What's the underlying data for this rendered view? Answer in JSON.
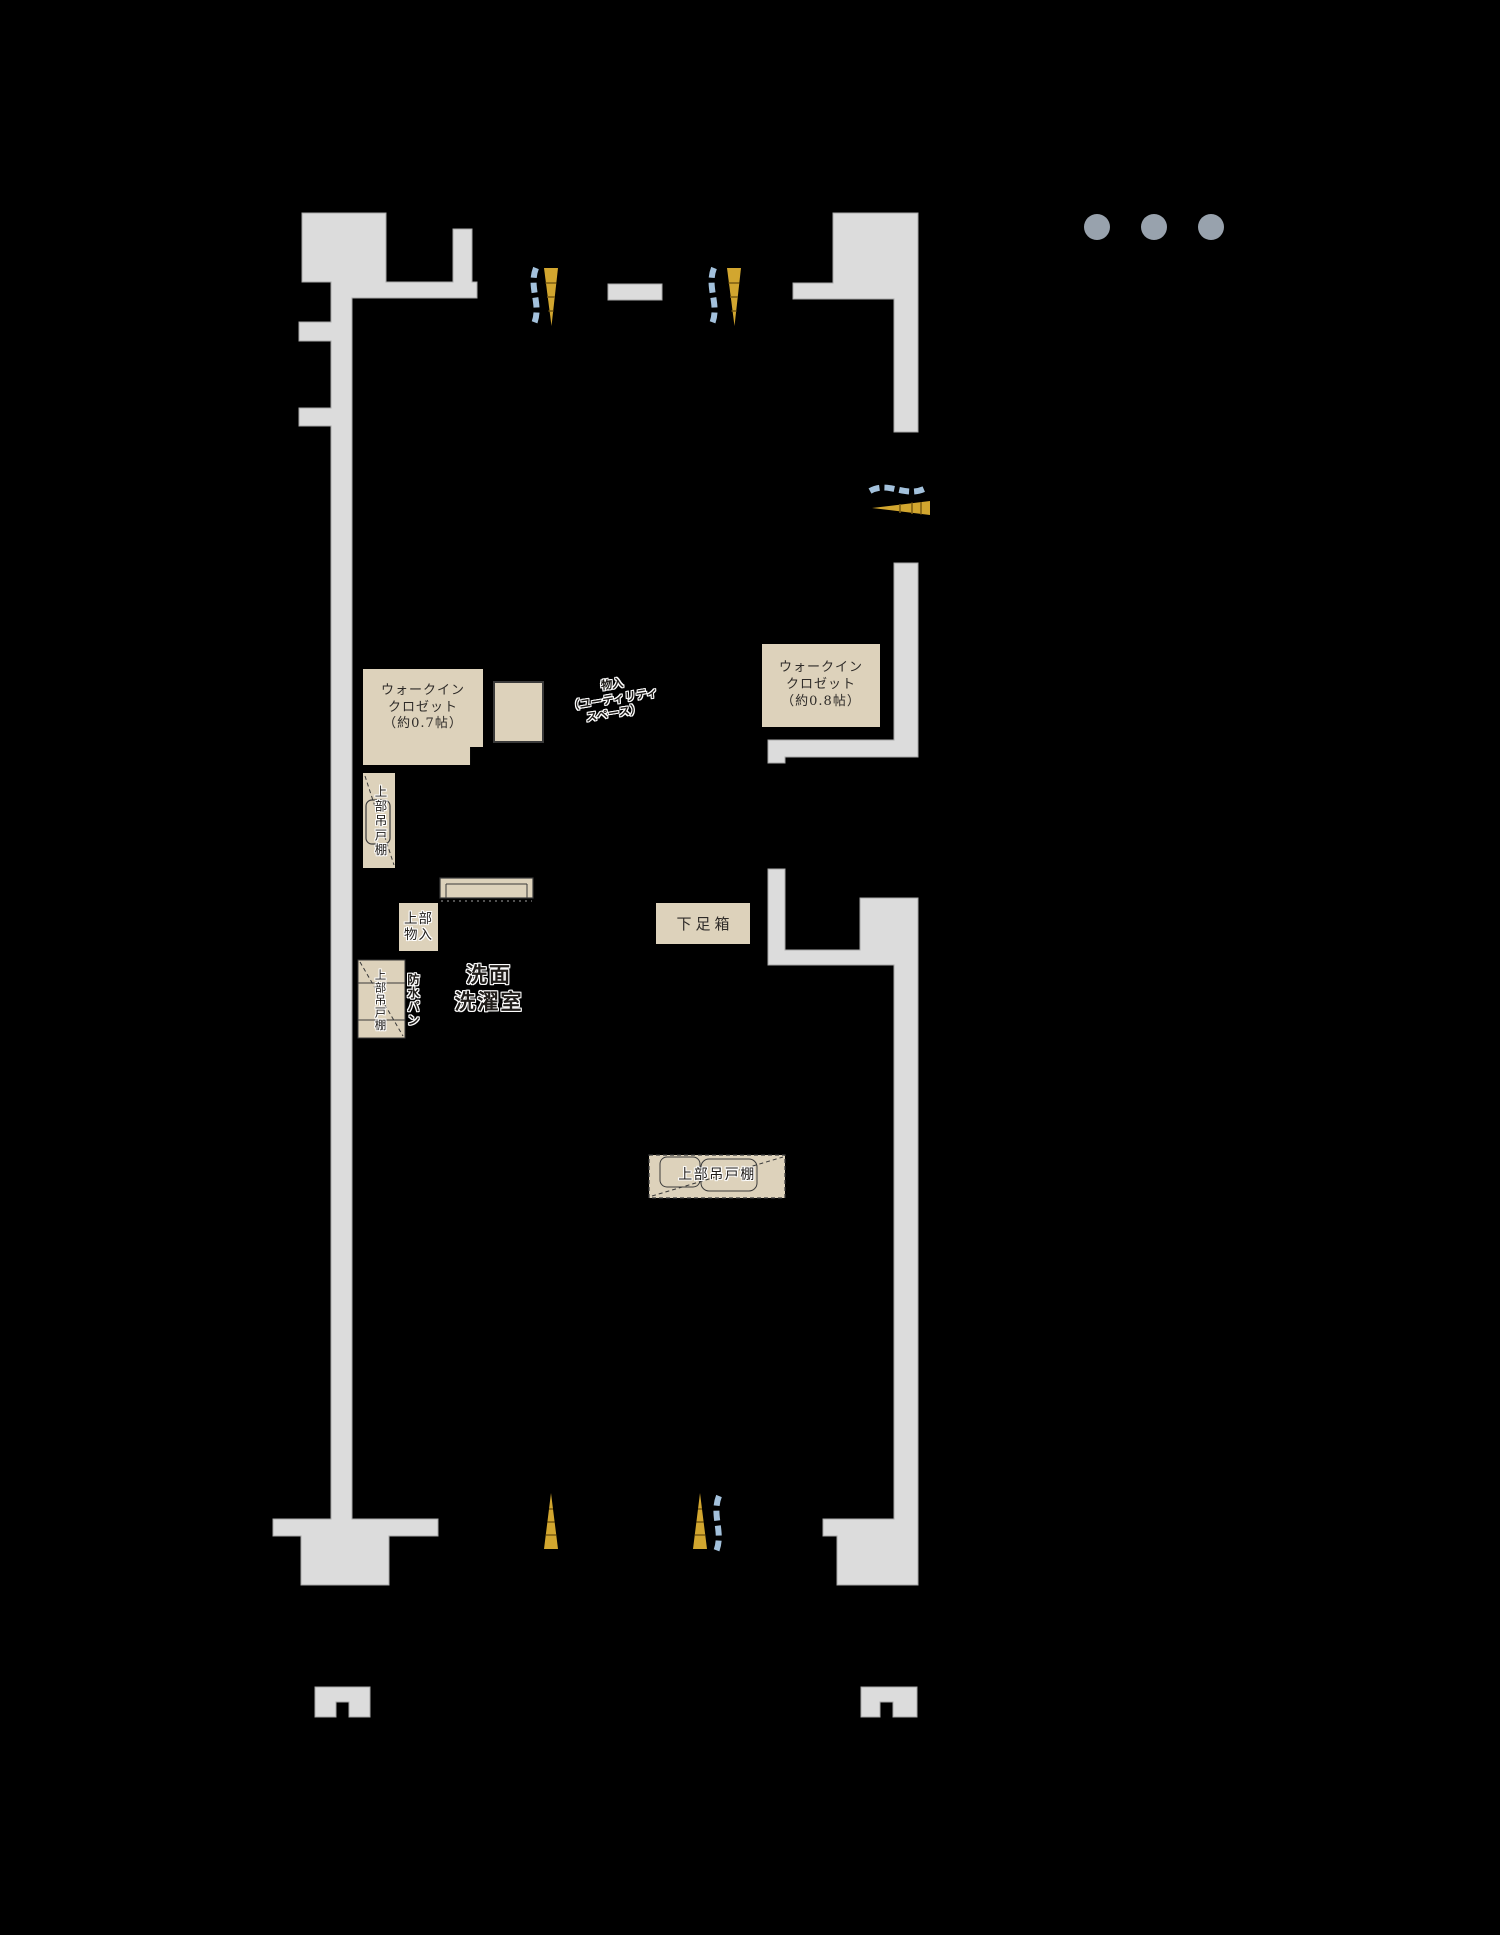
{
  "palette": {
    "background": "#000000",
    "wall_fill": "#dcdcdc",
    "wall_edge": "#a9a9a9",
    "fixture_fill": "#ddd2bb",
    "fixture_line": "#3a3a3a",
    "window_gold": "#d2a62f",
    "window_gold_line": "#7a5c12",
    "window_curtain_blue": "#a3c1dc",
    "dot_gray": "#98a2ad",
    "text_dark": "#2e2b28"
  },
  "carousel_dots": {
    "count": 3
  },
  "labels": {
    "wic_right": "ウォークイン\nクロゼット\n（約0.8帖）",
    "wic_left": "ウォークイン\nクロゼット\n（約0.7帖）",
    "utility_storage": "物入\n（ユーティリティ\nスペース）",
    "washroom": "洗面\n洗濯室",
    "shoe_box": "下足箱",
    "upper_storage": "上部\n物入",
    "vanity_upper_shelf": "上部吊戸棚",
    "laundry_upper_shelf": "上部吊戸棚",
    "waterproof_pan": "防水パン",
    "kitchen_upper_shelf": "上部吊戸棚"
  }
}
